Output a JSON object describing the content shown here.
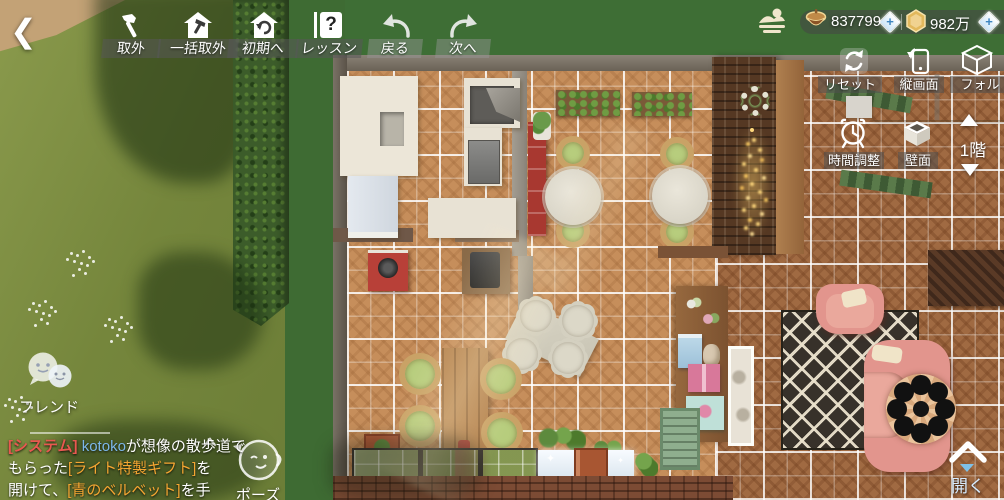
{
  "toolbar": {
    "items": [
      {
        "id": "remove",
        "label": "取外"
      },
      {
        "id": "batch_remove",
        "label": "一括取外"
      },
      {
        "id": "to_initial",
        "label": "初期へ"
      },
      {
        "id": "lesson",
        "label": "レッスン"
      },
      {
        "id": "undo",
        "label": "戻る"
      },
      {
        "id": "redo",
        "label": "次へ"
      }
    ]
  },
  "currency": {
    "acorns": "837799",
    "gold": "982万"
  },
  "right_panel": {
    "reset": "リセット",
    "portrait": "縦画面",
    "folder": "フォル",
    "time_adjust": "時間調整",
    "wall": "壁面"
  },
  "floor_selector": {
    "label": "1階"
  },
  "friend": {
    "label": "フレンド"
  },
  "pose": {
    "label": "ポーズ"
  },
  "open_panel": {
    "label": "開く"
  },
  "chat": {
    "tag": "[システム]",
    "user": "kotoko",
    "line1_rest": "が想像の散歩道で",
    "line2_pre": "もらった",
    "line2_gift": "[ライト特製ギフト]",
    "line2_post": "を",
    "line3_pre": "開けて、",
    "line3_gift": "[青のベルベット]",
    "line3_post": "を手"
  },
  "icons": {
    "back": "❮",
    "plus": "+",
    "question": "?"
  },
  "colors": {
    "gift_orange": "#f5a632",
    "chat_blue": "#7db8ea",
    "tag_red": "#e85850",
    "light_gold": "#ffd87c",
    "sofa_pink": "#e2958d"
  }
}
